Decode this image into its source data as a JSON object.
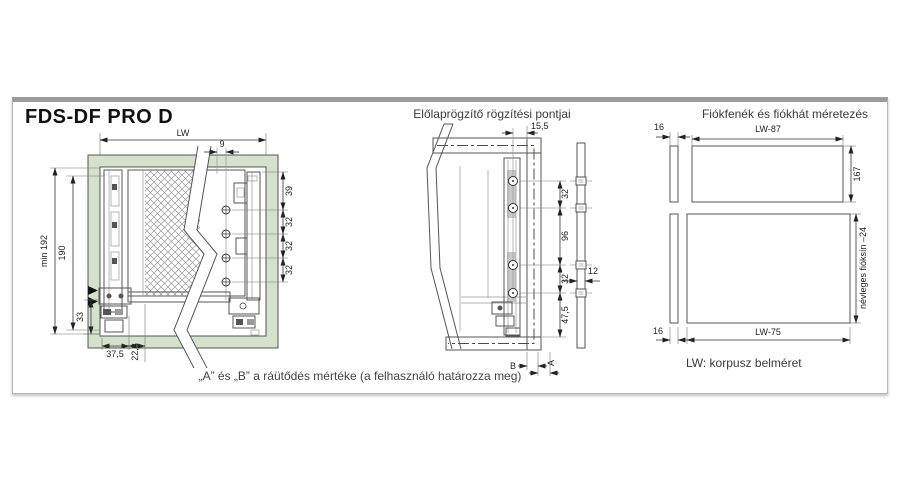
{
  "card": {
    "title": "FDS-DF PRO D"
  },
  "left": {
    "caption": "„A” és „B” a ráütődés mértéke (a felhasználó határozza meg)",
    "dims": {
      "lw": "LW",
      "d9": "9",
      "min192": "min 192",
      "d190": "190",
      "d33": "33",
      "d37_5": "37,5",
      "d22_8": "22,8",
      "d39": "39",
      "d32a": "32",
      "d32b": "32",
      "d32c": "32"
    }
  },
  "middle": {
    "title": "Előlaprögzítő rögzítési pontjai",
    "dims": {
      "d15_5": "15,5",
      "d32a": "32",
      "d96": "96",
      "d32b": "32",
      "d47_5": "47,5",
      "d12": "12",
      "b": "B",
      "a": "A"
    }
  },
  "right": {
    "title": "Fiókfenék és fiókhát méretezés",
    "note": "LW: korpusz belméret",
    "dims": {
      "d16_top": "16",
      "lw87": "LW-87",
      "d167": "167",
      "nevleges": "névleges fióksín –24",
      "d16_bottom": "16",
      "lw75": "LW-75"
    }
  },
  "colors": {
    "green": "#d5e0cd",
    "line": "#555555",
    "top_bar": "#9b9b9b"
  }
}
